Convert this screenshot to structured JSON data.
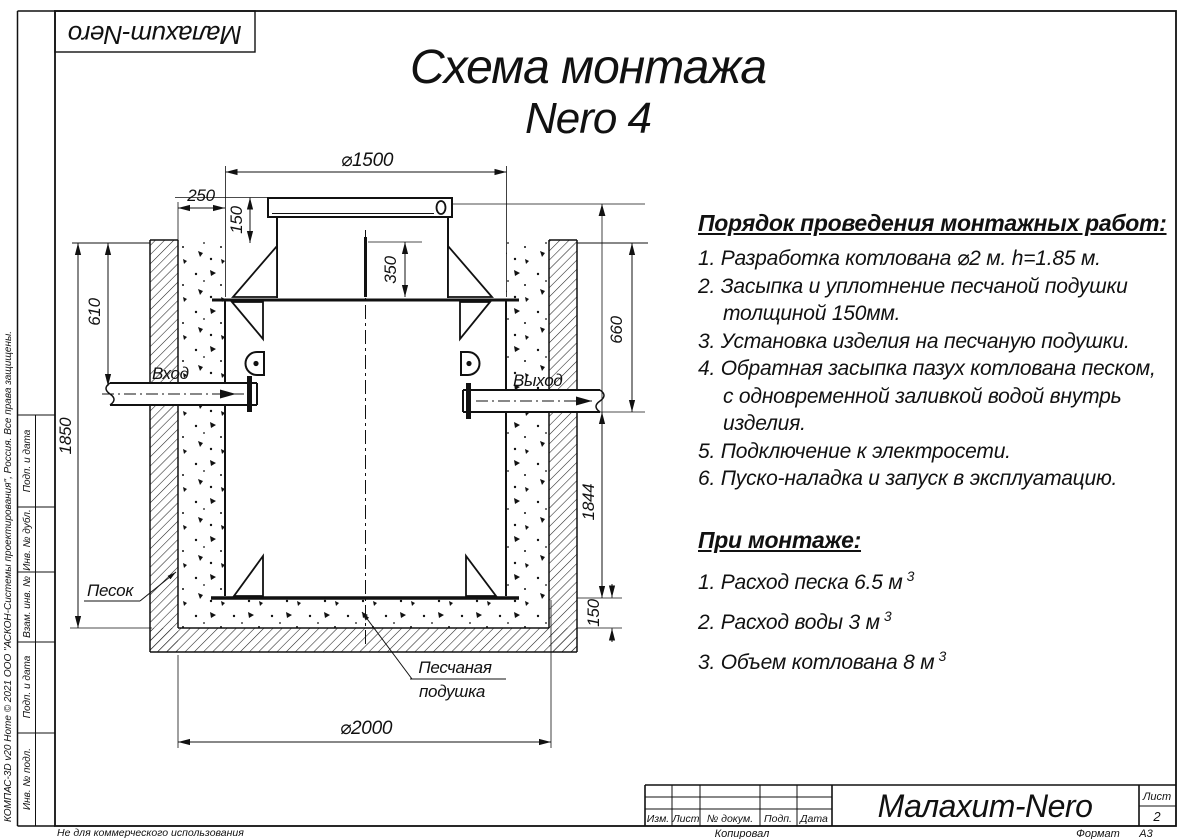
{
  "title": {
    "line1": "Схема монтажа",
    "line2": "Nero 4"
  },
  "corner_stamp": "Малахит-Nero",
  "instructions": {
    "heading": "Порядок проведения монтажных работ:",
    "items": [
      {
        "lines": [
          "1. Разработка котлована ⌀2 м. h=1.85 м."
        ]
      },
      {
        "lines": [
          "2. Засыпка и уплотнение песчаной подушки",
          "толщиной 150мм."
        ]
      },
      {
        "lines": [
          "3. Установка изделия на песчаную подушки."
        ]
      },
      {
        "lines": [
          "4. Обратная засыпка пазух котлована песком,",
          "с одновременной заливкой водой внутрь",
          "изделия."
        ]
      },
      {
        "lines": [
          "5. Подключение к электросети."
        ]
      },
      {
        "lines": [
          "6. Пуско-наладка и запуск в эксплуатацию."
        ]
      }
    ]
  },
  "montage": {
    "heading": "При монтаже:",
    "items": [
      {
        "text": "1. Расход песка 6.5 м",
        "sup": "3"
      },
      {
        "text": "2. Расход воды 3 м",
        "sup": "3"
      },
      {
        "text": "3. Объем котлована 8 м",
        "sup": "3"
      }
    ]
  },
  "dimensions": {
    "d1500": "⌀1500",
    "d250": "250",
    "d150_top": "150",
    "d350": "350",
    "d610": "610",
    "d1850": "1850",
    "d660": "660",
    "d1844": "1844",
    "d150_bottom": "150",
    "d2000": "⌀2000"
  },
  "labels": {
    "inlet": "Вход",
    "outlet": "Выход",
    "sand": "Песок",
    "cushion_line1": "Песчаная",
    "cushion_line2": "подушка"
  },
  "title_block": {
    "col_izm": "Изм.",
    "col_list": "Лист",
    "col_doc": "№ докум.",
    "col_podp": "Подп.",
    "col_data": "Дата",
    "product": "Малахит-Nero",
    "sheet_label": "Лист",
    "sheet_number": "2",
    "copied": "Копировал",
    "format_label": "Формат",
    "format_value": "А3"
  },
  "side_stamp": {
    "cell1": "Подп. и дата",
    "cell2": "Инв. № дубл.",
    "cell3": "Взам. инв. №",
    "cell4": "Подп. и дата",
    "cell5": "Инв. № подл.",
    "copyright": "КОМПАС-3D v20 Home © 2021 ООО \"АСКОН-Системы проектирования\", Россия. Все права защищены.",
    "non_commercial": "Не для коммерческого использования"
  },
  "colors": {
    "ink": "#111111",
    "paper": "#ffffff"
  }
}
